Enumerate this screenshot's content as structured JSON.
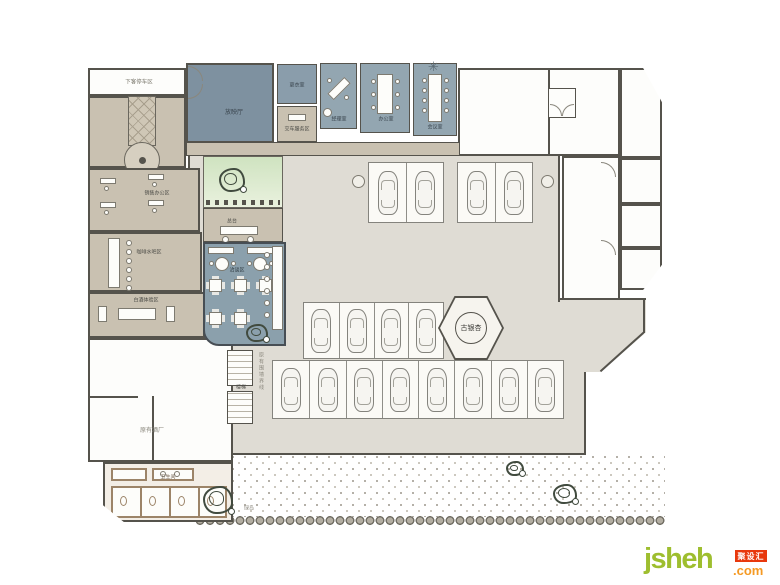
{
  "plan": {
    "labels": {
      "drop_off": "下客停车区",
      "screening_room": "放映厅",
      "locker_room": "更衣室",
      "delivery_room": "交车服务区",
      "manager_room": "经理室",
      "office": "办公室",
      "meeting_room": "会议室",
      "sales_office": "销售办公区",
      "coffee_bar": "咖啡水吧区",
      "liquor_area": "白酒体验区",
      "lounge": "洽谈区",
      "reception_desk": "总台",
      "stairs": "楼梯",
      "boundary_note": "原有围墙界线",
      "old_winery": "原有酒厂",
      "washroom": "卫生间",
      "ginkgo": "古银杏",
      "green_island": "绿岛",
      "fan_icon": "✳"
    },
    "parking": {
      "pads": [
        {
          "id": "top-a",
          "stalls": 2
        },
        {
          "id": "top-b",
          "stalls": 2
        },
        {
          "id": "mid",
          "stalls": 4
        },
        {
          "id": "bottom",
          "stalls": 8
        }
      ],
      "total_cars": 16
    }
  },
  "watermark": {
    "brand": "jsheh",
    "tld": ".com",
    "badge": "聚设汇"
  },
  "colors": {
    "wall": "#55534c",
    "hall_floor": "#dfdcd4",
    "beige": "#c9c1b1",
    "slate_dark": "#7e91a0",
    "slate": "#93a6b1",
    "cafe_blue": "#8ba0ac",
    "washroom_brown": "#9c8468",
    "courtyard_green": "#cfe3c0",
    "brand_green": "#9ebe2f",
    "brand_orange": "#f59a23",
    "badge_red": "#e8380d"
  }
}
